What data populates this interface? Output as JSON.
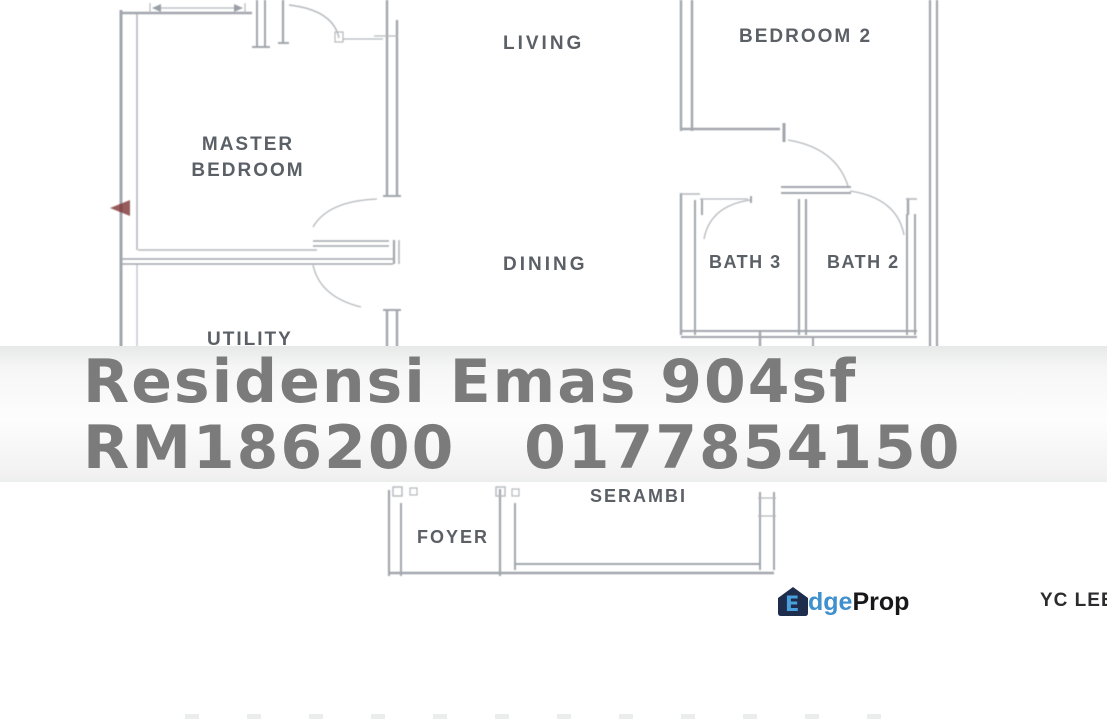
{
  "plan": {
    "rooms": {
      "living": "LIVING",
      "bedroom_2": "BEDROOM 2",
      "master_line1": "MASTER",
      "master_line2": "BEDROOM",
      "dining": "DINING",
      "bath_3": "BATH 3",
      "bath_2": "BATH 2",
      "utility": "UTILITY",
      "serambi": "SERAMBI",
      "foyer": "FOYER"
    }
  },
  "overlay": {
    "line1": "Residensi Emas 904sf",
    "line2": "RM186200   0177854150",
    "property_name": "Residensi Emas",
    "size": "904sf",
    "price": "RM186200",
    "phone": "0177854150"
  },
  "watermark": {
    "brand_icon_letter": "E",
    "brand_rest": "dge",
    "brand_suffix": "Prop",
    "agent": "YC LEE"
  },
  "colors": {
    "plan_line": "#a2a7ad",
    "label_text": "#5b6066",
    "overlay_text": "#7b7b7b",
    "brand_navy": "#1f2d4d",
    "brand_blue": "#3f90cc",
    "brand_dark": "#18181a",
    "agent_text": "#2c2c2e",
    "pointer_red": "#7d3434"
  }
}
